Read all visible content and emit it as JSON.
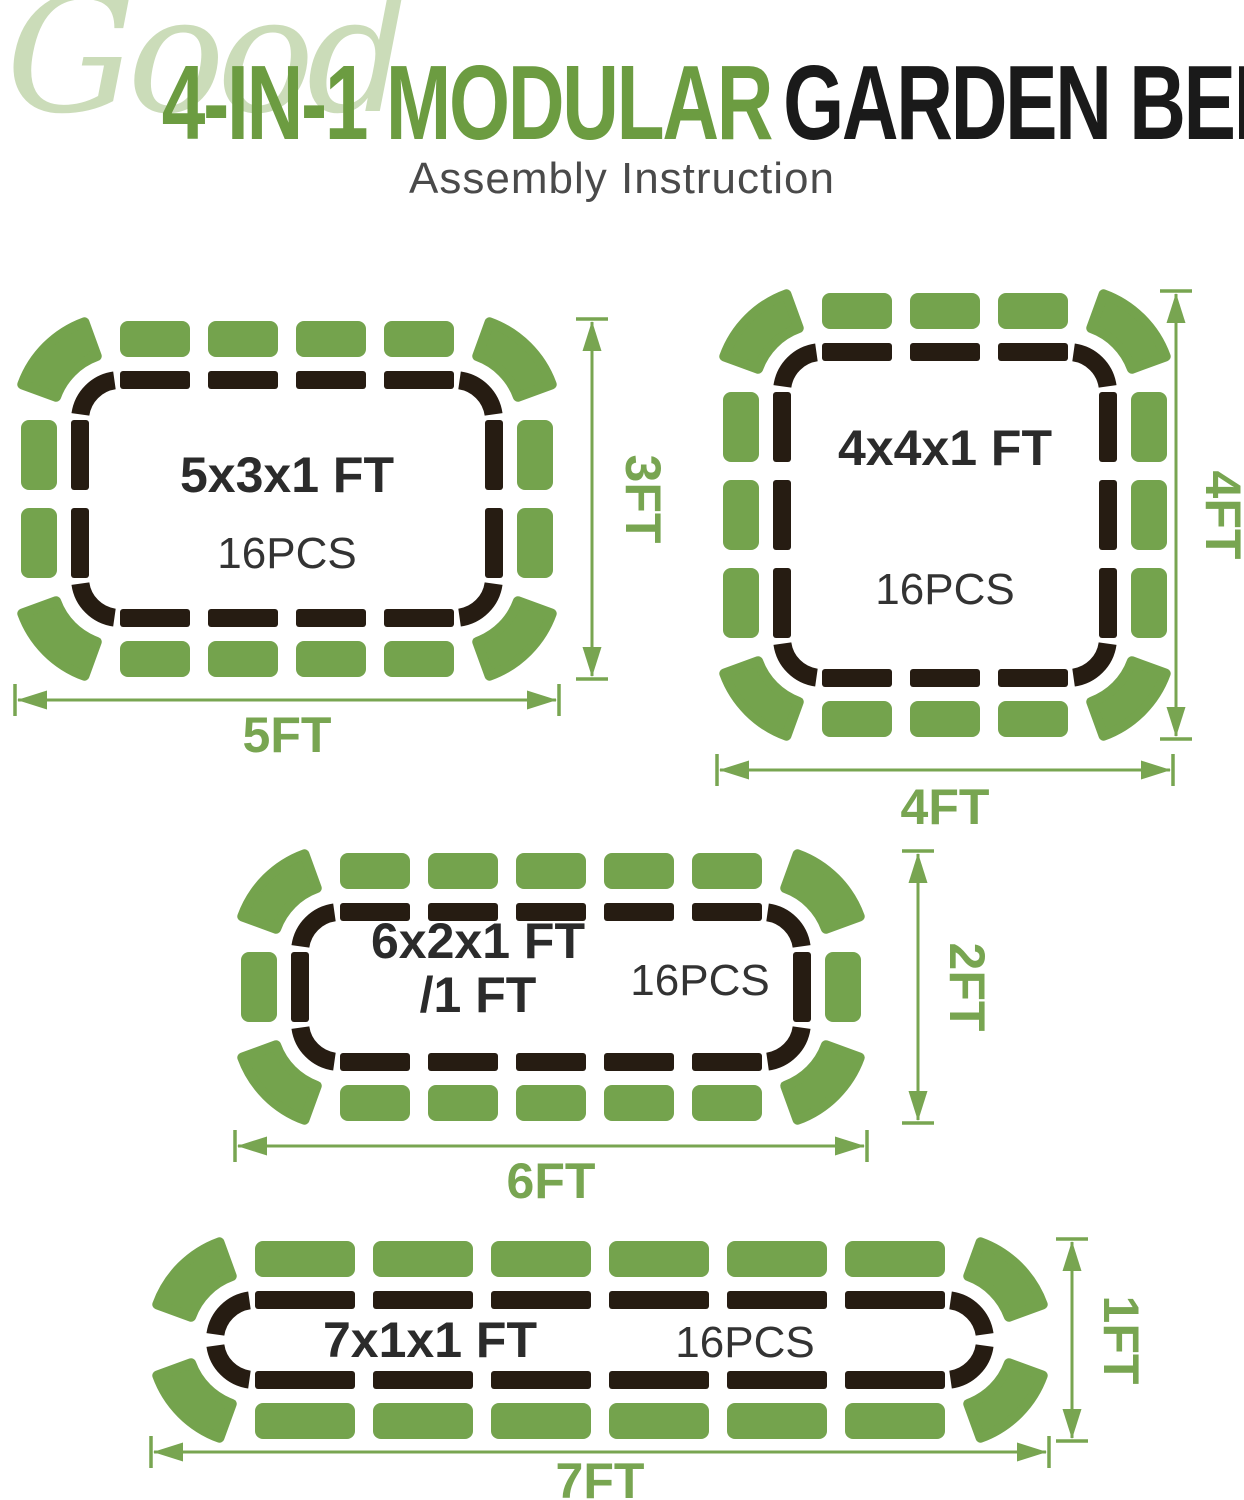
{
  "header": {
    "watermark": "Good",
    "title_green": "4-IN-1 MODULAR",
    "title_dark": "GARDEN BED",
    "subtitle": "Assembly Instruction"
  },
  "colors": {
    "panel_green": "#74A34D",
    "dim_green": "#78A551",
    "title_green": "#6C9C41",
    "watermark_green": "#CBDCB9",
    "frame_dark": "#261C12",
    "label_dark": "#2B2B2B",
    "pcs_dark": "#333333",
    "subtitle_gray": "#4A4A4A"
  },
  "diagrams": [
    {
      "name": "bed-5x3",
      "size_label": [
        "5x3x1 FT"
      ],
      "pcs": "16PCS",
      "width_ft": "5FT",
      "height_ft": "3FT",
      "panels": {
        "top": 4,
        "bottom": 4,
        "left": 2,
        "right": 2,
        "corners": 4,
        "total": 16
      },
      "layout": {
        "x0": 80,
        "y0": 380,
        "panel_len": 70,
        "side_len": 70,
        "gap": 18,
        "label_xy": [
          287,
          492
        ],
        "pcs_xy": [
          287,
          568
        ],
        "dim_v": {
          "x": 592,
          "label_xy": [
            626,
            499
          ]
        },
        "dim_h": {
          "y": 700,
          "label_xy": [
            287,
            752
          ]
        }
      }
    },
    {
      "name": "bed-4x4",
      "size_label": [
        "4x4x1 FT"
      ],
      "pcs": "16PCS",
      "width_ft": "4FT",
      "height_ft": "4FT",
      "panels": {
        "top": 3,
        "bottom": 3,
        "left": 3,
        "right": 3,
        "corners": 4,
        "total": 16
      },
      "layout": {
        "x0": 782,
        "y0": 352,
        "panel_len": 70,
        "side_len": 70,
        "gap": 18,
        "label_xy": [
          945,
          465
        ],
        "pcs_xy": [
          945,
          604
        ],
        "dim_v": {
          "x": 1176,
          "label_xy": [
            1206,
            515
          ]
        },
        "dim_h": {
          "y": 770,
          "label_xy": [
            945,
            824
          ]
        }
      }
    },
    {
      "name": "bed-6x2",
      "size_label": [
        "6x2x1 FT",
        "/1 FT"
      ],
      "pcs": "16PCS",
      "width_ft": "6FT",
      "height_ft": "2FT",
      "panels": {
        "top": 5,
        "bottom": 5,
        "left": 1,
        "right": 1,
        "corners": 4,
        "total": 16
      },
      "layout": {
        "x0": 300,
        "y0": 912,
        "panel_len": 70,
        "side_len": 70,
        "gap": 18,
        "label_xy": [
          478,
          958
        ],
        "pcs_xy": [
          700,
          995
        ],
        "dim_v": {
          "x": 918,
          "label_xy": [
            950,
            987
          ]
        },
        "dim_h": {
          "y": 1146,
          "label_xy": [
            551,
            1198
          ]
        }
      }
    },
    {
      "name": "bed-7x1",
      "size_label": [
        "7x1x1 FT"
      ],
      "pcs": "16PCS",
      "width_ft": "7FT",
      "height_ft": "1FT",
      "panels": {
        "top": 6,
        "bottom": 6,
        "left": 0,
        "right": 0,
        "corners": 4,
        "total": 16
      },
      "layout": {
        "x0": 215,
        "y0": 1300,
        "panel_len": 100,
        "side_len": 70,
        "gap": 18,
        "label_xy": [
          430,
          1357
        ],
        "pcs_xy": [
          745,
          1357
        ],
        "dim_v": {
          "x": 1072,
          "label_xy": [
            1104,
            1340
          ]
        },
        "dim_h": {
          "y": 1452,
          "label_xy": [
            600,
            1498
          ]
        }
      }
    }
  ]
}
